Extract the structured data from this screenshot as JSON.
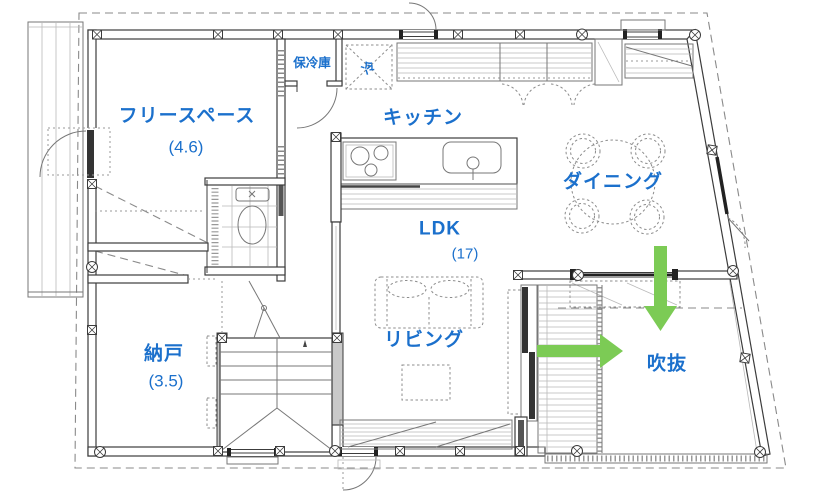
{
  "rooms": {
    "free_space": {
      "label": "フリースペース",
      "size": "(4.6)"
    },
    "kitchen": {
      "label": "キッチン"
    },
    "dining": {
      "label": "ダイニング"
    },
    "ldk": {
      "label": "LDK",
      "size": "(17)"
    },
    "living": {
      "label": "リビング"
    },
    "storeroom": {
      "label": "納戸",
      "size": "(3.5)"
    },
    "void": {
      "label": "吹抜"
    },
    "cold_storage": {
      "label": "保冷庫"
    },
    "refrigerator": {
      "label": "冷"
    }
  },
  "annotations": {
    "airflow_down_icon": "green-arrow-down",
    "airflow_right_icon": "green-arrow-right"
  },
  "colors": {
    "label_blue": "#1b70cc",
    "arrow_green": "#7ccb55",
    "line_dark": "#3c3c3c",
    "line_mid": "#777777",
    "line_light": "#b9b9b9",
    "background": "#ffffff"
  }
}
